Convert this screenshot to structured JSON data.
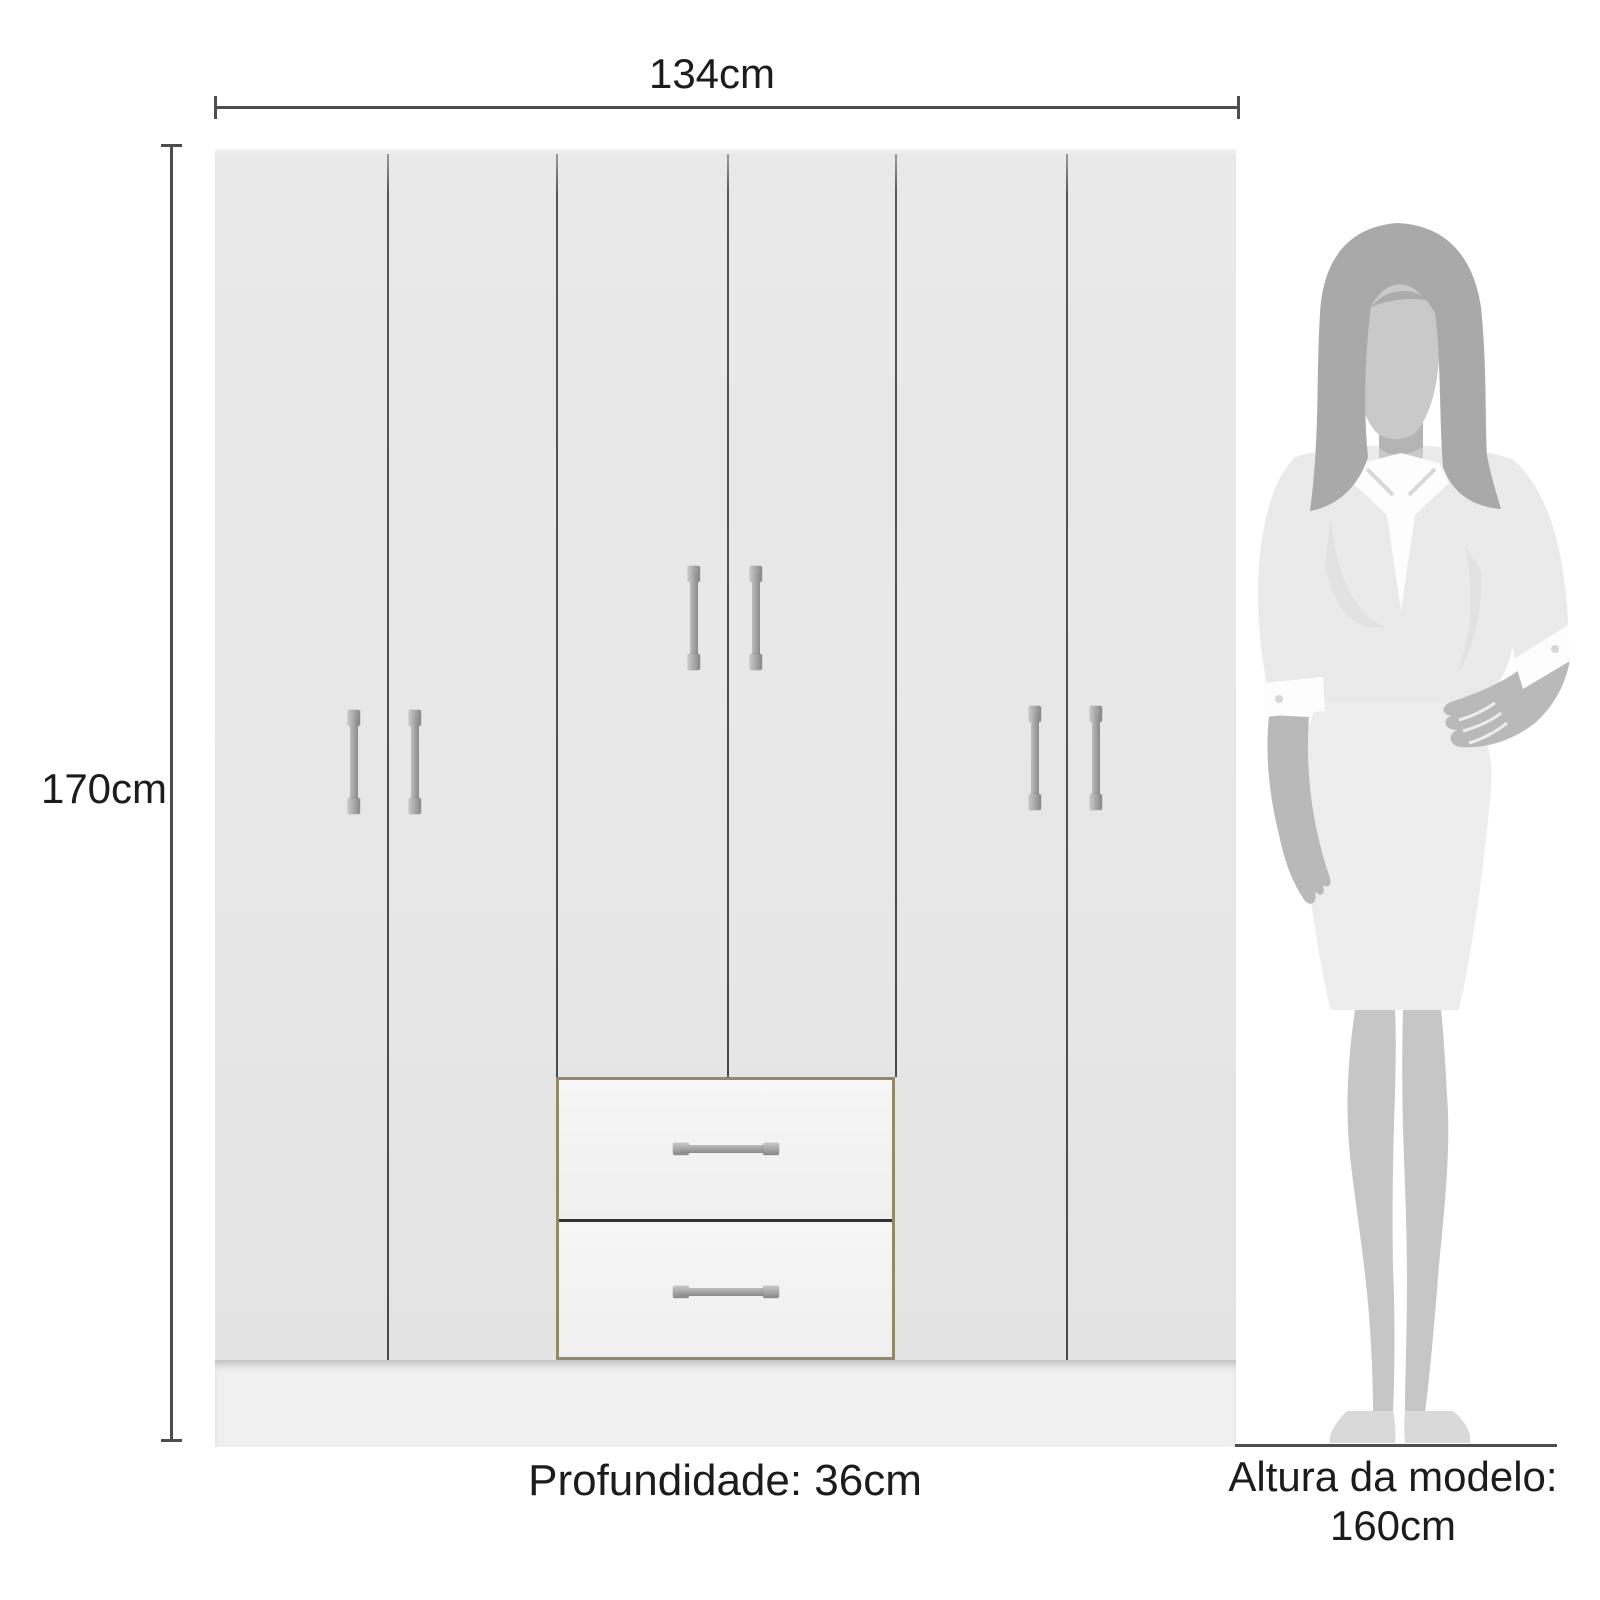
{
  "meta": {
    "type": "product-dimension-diagram",
    "product": "6-door wardrobe with 2 drawers and model height reference"
  },
  "labels": {
    "width": "134cm",
    "height": "170cm",
    "depth": "Profundidade: 36cm",
    "model_height_line1": "Altura da modelo:",
    "model_height_line2": "160cm"
  },
  "wardrobe": {
    "door_count": 6,
    "drawer_count": 2,
    "handle_count": 8,
    "colors": {
      "body": "#e7e7e7",
      "drawer_face": "#f3f3f3",
      "plinth": "#f0f0f0",
      "drawer_trim": "#94886b",
      "door_gap": "#4f4f4f",
      "handle_light": "#c7c7c7",
      "handle_dark": "#888888"
    }
  },
  "figure": {
    "subject": "female model silhouette",
    "colors": {
      "hair": "#a9a9a9",
      "face": "#c9c9c9",
      "skin": "#b9b9b9",
      "shirt": "#fdfdfd",
      "jacket": "#eaeaea",
      "skirt": "#ededed",
      "legs": "#c6c6c6",
      "shoes": "#d9d9d9"
    }
  },
  "annotation": {
    "line_color": "#4d4d4d",
    "text_color": "#1c1c1c"
  }
}
